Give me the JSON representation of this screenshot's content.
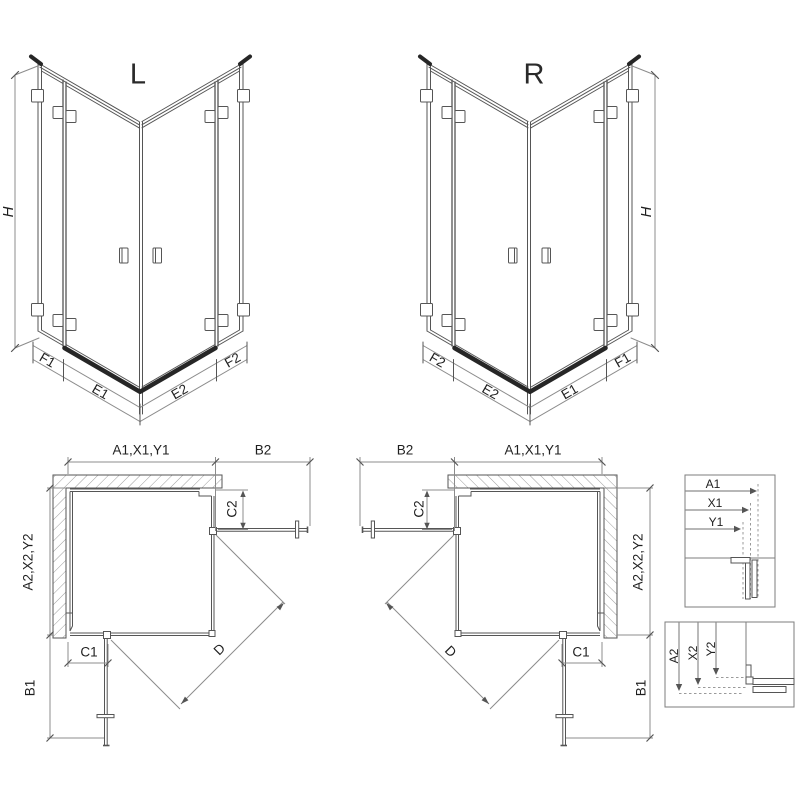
{
  "colors": {
    "line": "#555555",
    "dim_line": "#8c8c8c",
    "hatch": "#9c9c9c",
    "threshold": "#262626",
    "label_text": "#1f1f1f",
    "background": "#ffffff"
  },
  "iso_left": {
    "title": "L",
    "height_dim": "H",
    "segment_dims": [
      "F1",
      "E1",
      "E2",
      "F2"
    ]
  },
  "iso_right": {
    "title": "R",
    "height_dim": "H",
    "segment_dims": [
      "F2",
      "E2",
      "E1",
      "F1"
    ]
  },
  "plan_left": {
    "width_dim": "A1,X1,Y1",
    "door_dim_top": "B2",
    "depth_dim": "A2,X2,Y2",
    "door_dim_side": "B1",
    "fixed_dim_bottom": "C1",
    "fixed_dim_side": "C2",
    "diagonal_dim": "D"
  },
  "plan_right": {
    "width_dim": "A1,X1,Y1",
    "door_dim_top": "B2",
    "depth_dim": "A2,X2,Y2",
    "door_dim_side": "B1",
    "fixed_dim_bottom": "C1",
    "fixed_dim_side": "C2",
    "diagonal_dim": "D"
  },
  "detail_width": {
    "dims": [
      "A1",
      "X1",
      "Y1"
    ]
  },
  "detail_depth": {
    "dims": [
      "A2",
      "X2",
      "Y2"
    ]
  }
}
